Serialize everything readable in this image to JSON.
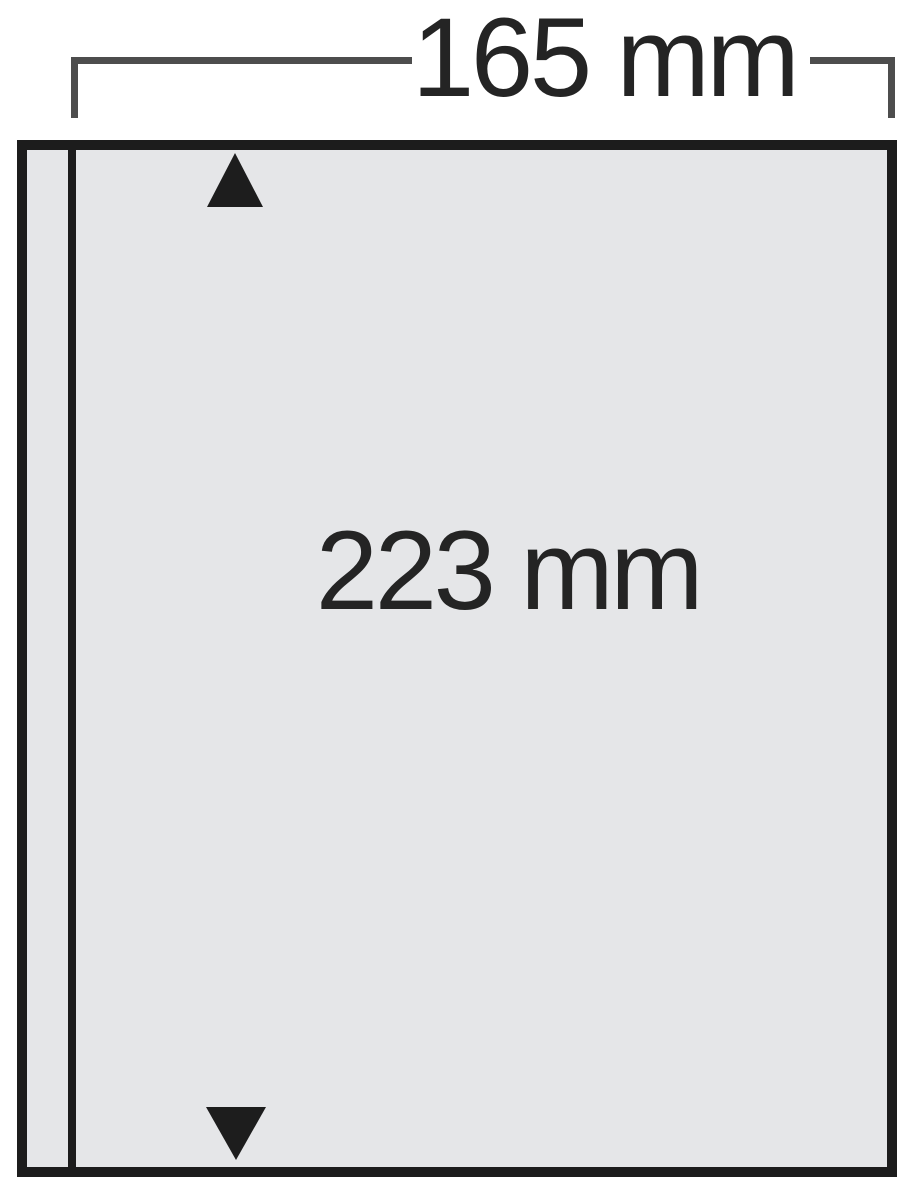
{
  "diagram": {
    "type": "product-dimension-diagram",
    "subject": "single-pocket album sheet",
    "background_color": "#ffffff",
    "dimensions": {
      "width_label": "165 mm",
      "height_label": "223 mm"
    },
    "dimension_bracket": {
      "line_color": "#4d4d4d",
      "text_color": "#242424"
    },
    "sheet": {
      "fill_color": "#e5e6e8",
      "border_color": "#1c1c1c",
      "seam_line_color": "#1c1c1c"
    },
    "icons": {
      "top_arrow": "up-triangle",
      "bottom_arrow": "down-triangle",
      "arrow_color": "#1d1d1d"
    }
  }
}
